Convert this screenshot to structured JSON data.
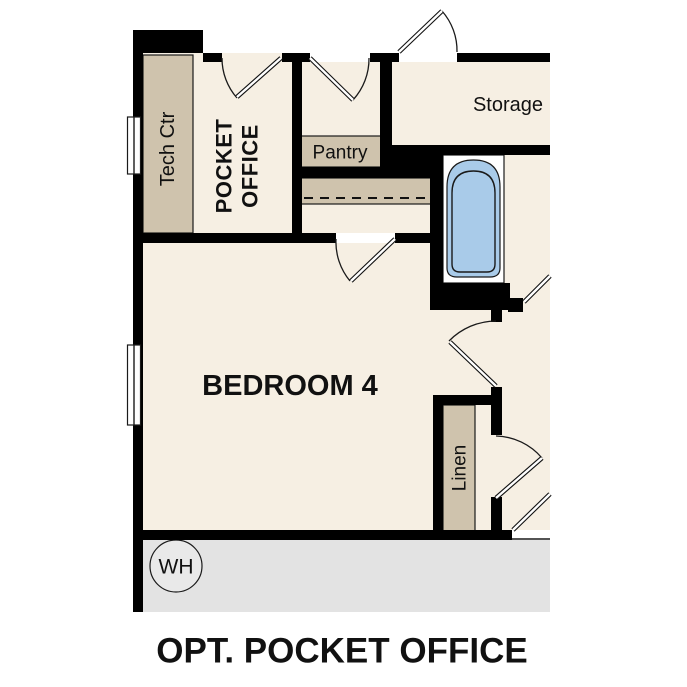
{
  "title": "OPT. POCKET OFFICE",
  "rooms": {
    "tech_ctr": "Tech Ctr",
    "pocket_office": {
      "lines": [
        "POCKET",
        "OFFICE"
      ]
    },
    "pantry": "Pantry",
    "storage": "Storage",
    "bedroom": "BEDROOM 4",
    "linen": "Linen",
    "water_heater": "WH"
  },
  "colors": {
    "floor": "#f6efe3",
    "casework": "#cfc3ad",
    "tub": "#a9cbe9",
    "garage_floor": "#e3e3e3",
    "wall": "#000000",
    "window": "#ffffff"
  }
}
